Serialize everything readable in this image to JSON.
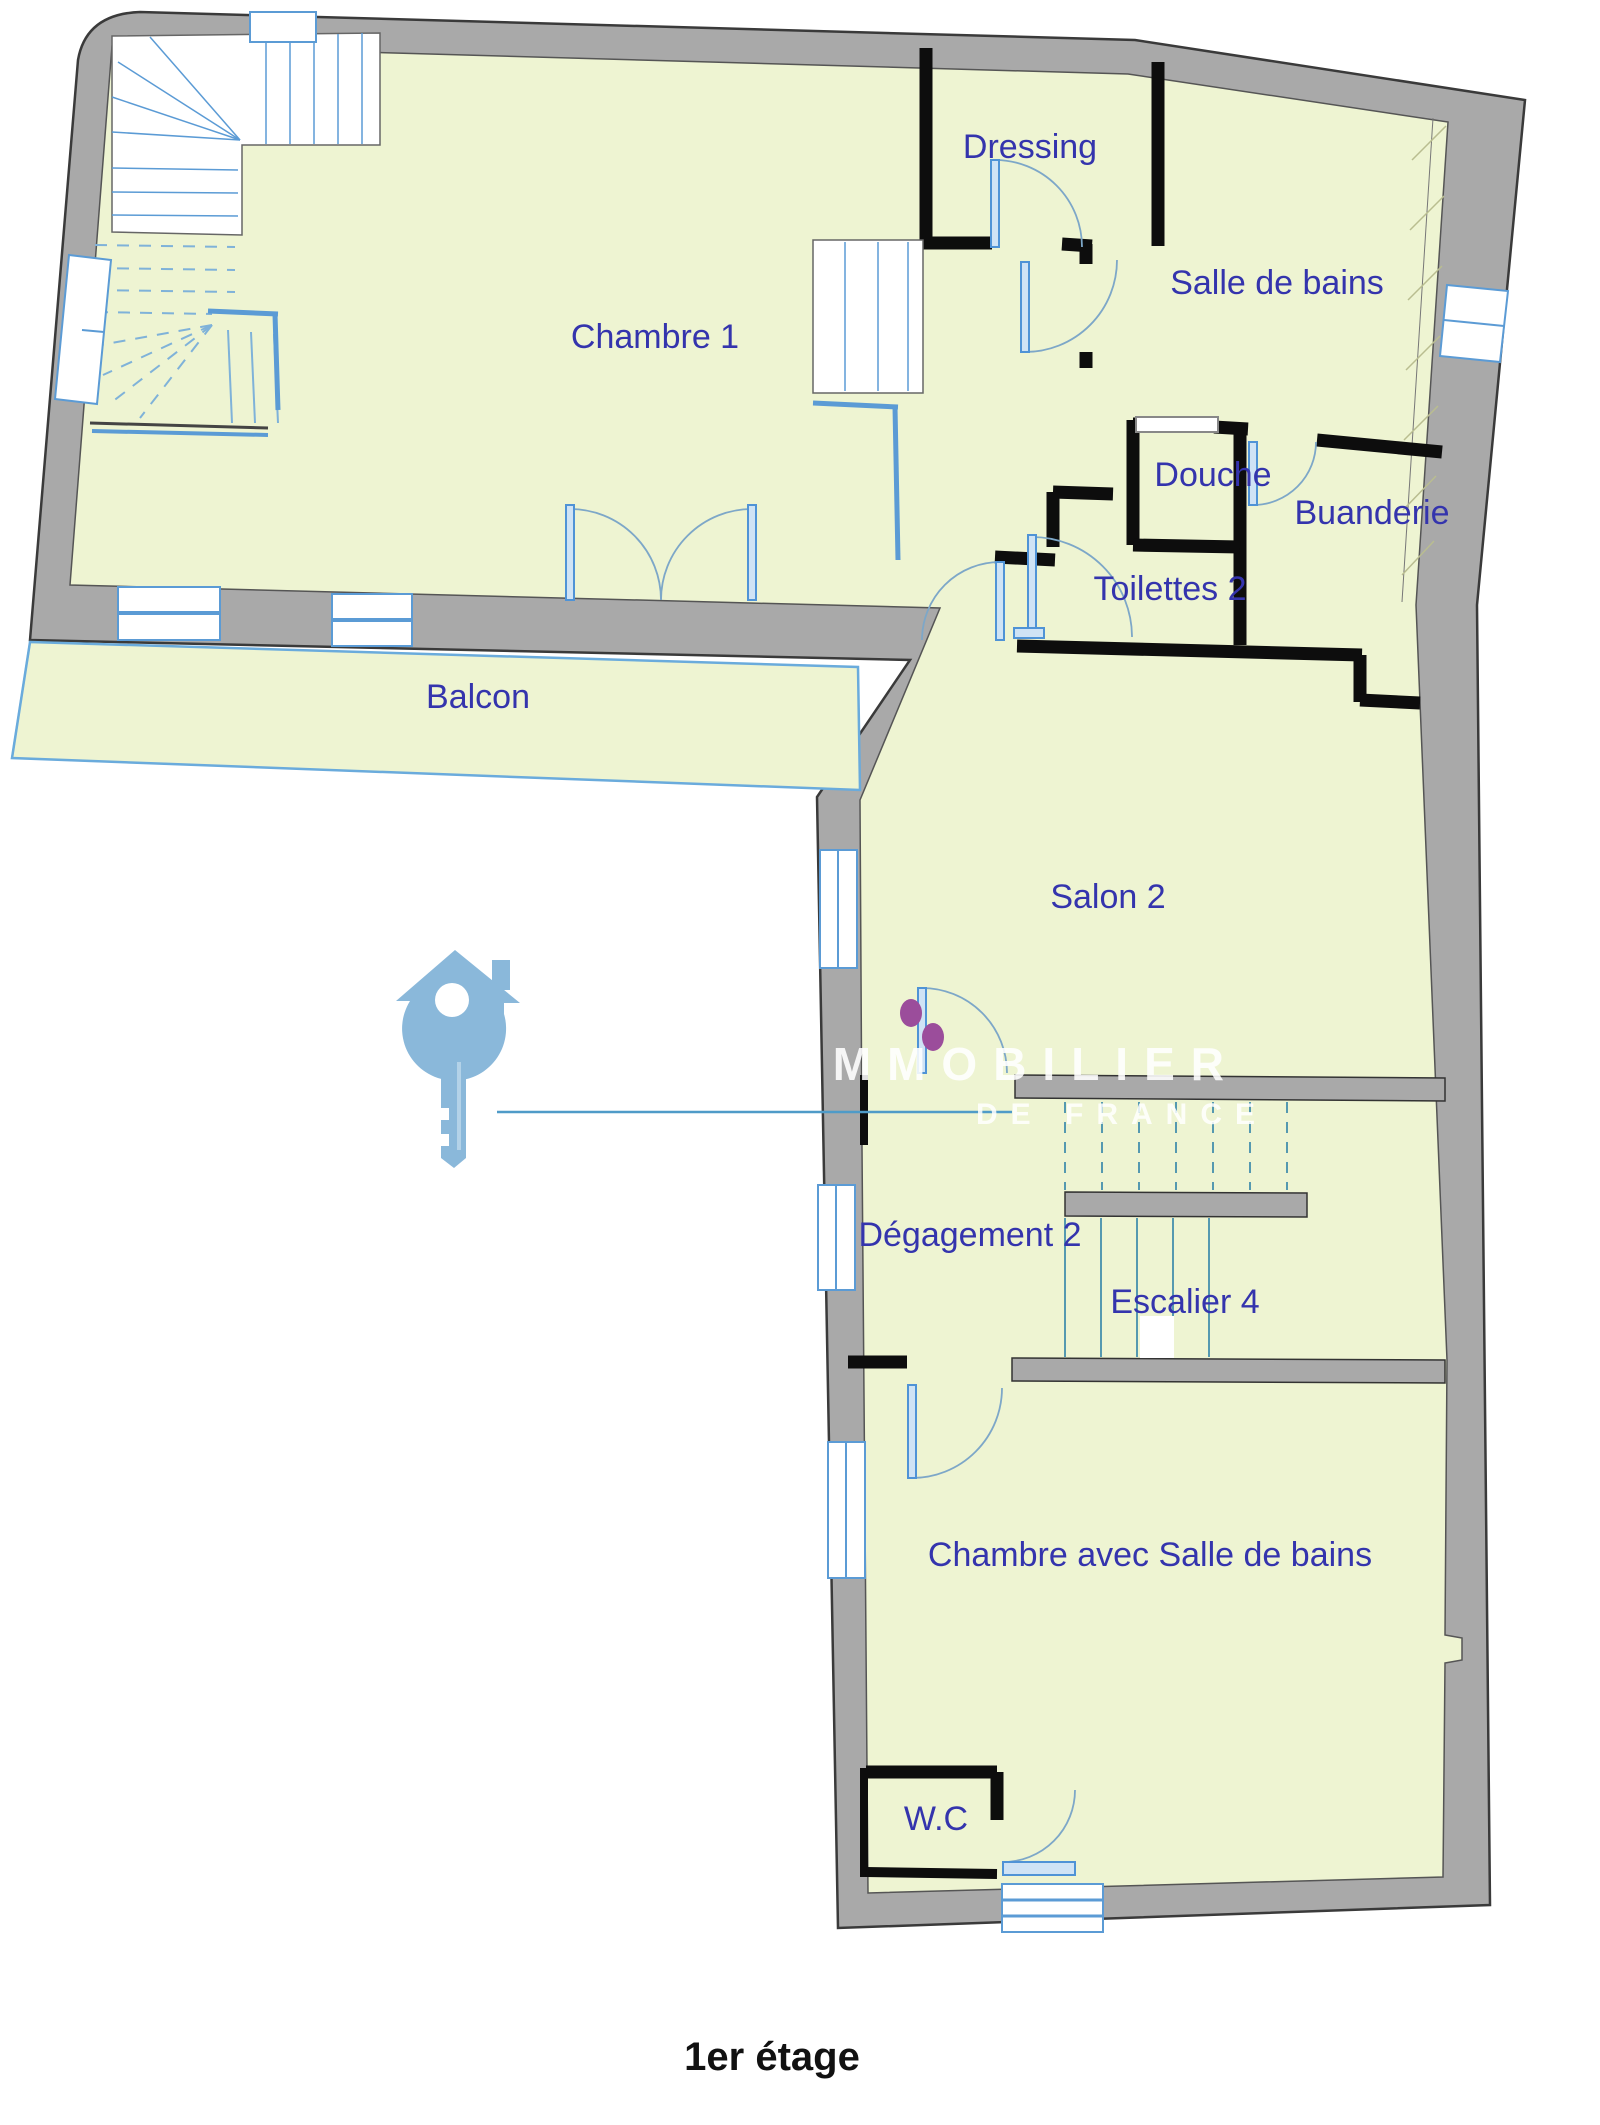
{
  "floor_title": "1er étage",
  "rooms": {
    "chambre1": "Chambre 1",
    "dressing": "Dressing",
    "salle_de_bains": "Salle de bains",
    "douche": "Douche",
    "buanderie": "Buanderie",
    "toilettes2": "Toilettes 2",
    "balcon": "Balcon",
    "salon2": "Salon 2",
    "degagement2": "Dégagement 2",
    "escalier4": "Escalier 4",
    "chambre_sdb": "Chambre avec Salle de bains",
    "wc": "W.C"
  },
  "watermark": {
    "brand_line1": "IMMOBILIER",
    "brand_line2": "DE FRANCE",
    "icon": "house-key-icon"
  },
  "colors": {
    "floor_fill": "#eef4d2",
    "exterior_wall": "#a9a9a9",
    "interior_wall": "#0d0d0d",
    "openings_blue": "#5b9bd5",
    "stair_line": "#5599b0",
    "label_blue": "#3434ad",
    "watermark_blue": "#8ab8da",
    "hinge_dot_purple": "#9b4d9b"
  }
}
